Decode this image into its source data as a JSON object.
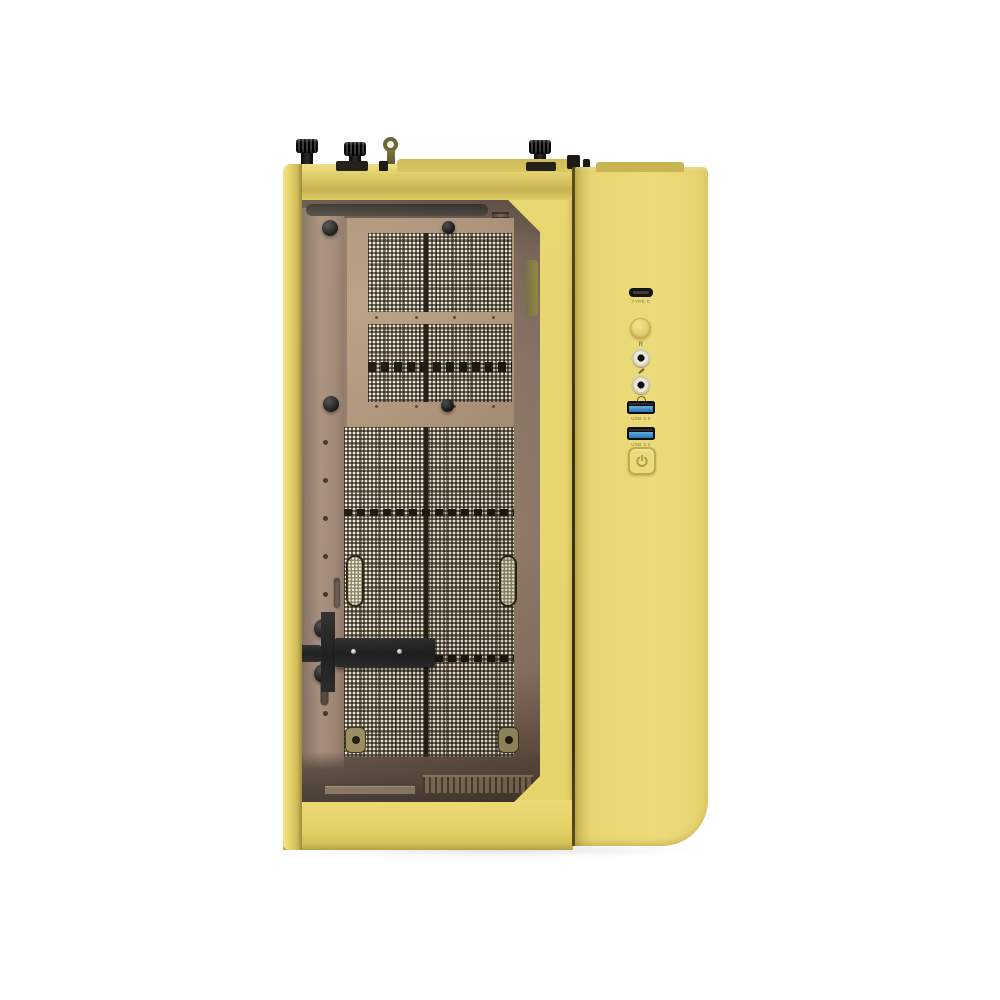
{
  "meta": {
    "description": "Product photo of a pastel-yellow PC tower case with tinted tempered-glass side panel, right-side three-quarter view on a white background",
    "background": "#ffffff"
  },
  "colors": {
    "panel_yellow": "#e7d56d",
    "panel_yellow_light": "#eedd7d",
    "panel_yellow_dark": "#cdb956",
    "panel_seam": "#3a3214",
    "interior_brown": "#9a8471",
    "tray_tan": "#b29878",
    "mesh_base": "#382f1f",
    "mesh_dot": "#eeeadb",
    "hardware_black": "#1a1a1a",
    "usb3_blue": "#2e7cc0",
    "jack_silver": "#ebe7db",
    "label_olive": "#8a7a3c"
  },
  "front_io": {
    "usb_c": {
      "name": "USB Type-C port",
      "label": "TYPE C"
    },
    "reset": {
      "name": "reset button",
      "label": "R"
    },
    "mic_jack": {
      "name": "microphone jack"
    },
    "headphone_jack": {
      "name": "headphone jack"
    },
    "usb3_ports": [
      {
        "label": "USB 3.0"
      },
      {
        "label": "USB 3.0"
      }
    ],
    "power": {
      "name": "power button"
    }
  },
  "hardware": {
    "top_thumbscrews": "3 black thumbscrews and 1 metal loop clip on top edge",
    "window": "tinted tempered-glass side window with chamfered right corners",
    "interior": "brown interior with white perforated mesh cable-management panels",
    "bracket": "black horizontal support bracket with 2 screws"
  }
}
